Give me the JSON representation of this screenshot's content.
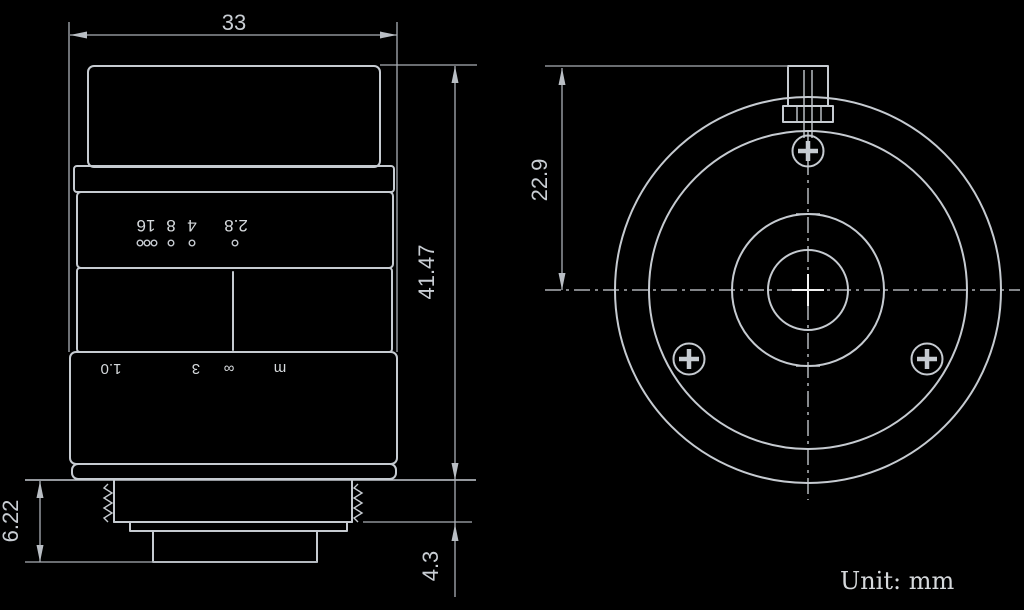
{
  "unit_note": "Unit: mm",
  "dimensions": {
    "top_width": "33",
    "overall_height": "41.47",
    "rear_protrusion": "6.22",
    "thread_length": "4.3",
    "flange_to_center": "22.9"
  },
  "side_view": {
    "aperture_scale": {
      "label": "2.8 4 8 16",
      "tokens": [
        "16",
        "8",
        "4",
        "2.8"
      ]
    },
    "focus_scale": {
      "label": "1.0 3 ∞ m",
      "tokens": [
        "1.0",
        "3",
        "∞",
        "m"
      ]
    }
  },
  "colors": {
    "background": "#000000",
    "line": "#c6cbd1",
    "dim_line": "#a9aeb5",
    "text": "#c9ced4",
    "bright": "#f2f2f2"
  }
}
